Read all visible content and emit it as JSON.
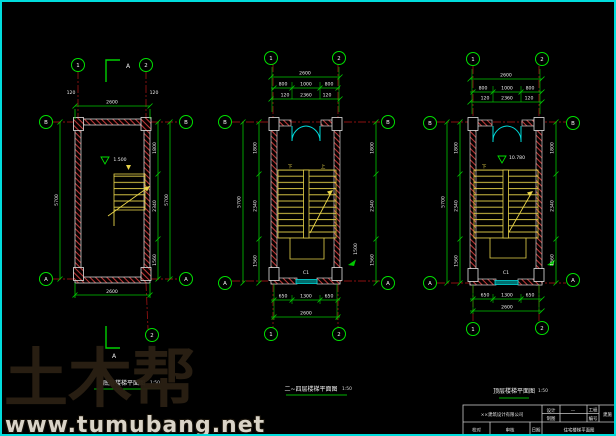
{
  "watermark": {
    "logo": "土木帮",
    "url": "www.tumubang.net"
  },
  "section_marks": {
    "top_label": "A",
    "bottom_label": "A"
  },
  "colors": {
    "dim_green": "#00c800",
    "axis_red": "#8c1111",
    "stair_yellow": "#e8d44a",
    "door_cyan": "#00d9d9"
  },
  "plans": [
    {
      "title": "底层楼梯平面图",
      "scale": "1:50",
      "elevation": "1.500",
      "axes": {
        "v1": "1",
        "v2": "2",
        "v_bottom": "2",
        "h_top": "B",
        "h_bottom": "A"
      },
      "dims": {
        "top_overall": "2600",
        "side_left_small": "120",
        "side_right_small": "120",
        "bottom_overall": "2600",
        "left_overall": "5700",
        "right_chain": [
          "1800",
          "2340",
          "1560"
        ],
        "right_overall": "5700"
      }
    },
    {
      "title": "二~四层楼梯平面图",
      "scale": "1:50",
      "flight_up": "上",
      "flight_down": "下",
      "window_tag": "C1",
      "axes": {
        "v1": "1",
        "v2": "2",
        "h_top": "B",
        "h_bottom": "A"
      },
      "dims": {
        "top_overall": "2600",
        "top_chain": [
          "800",
          "1000",
          "800"
        ],
        "top_chain2": [
          "120",
          "2360",
          "120"
        ],
        "bottom_chain": [
          "650",
          "1300",
          "650"
        ],
        "bottom_overall": "2600",
        "left_overall": "5700",
        "left_chain": [
          "1800",
          "2340",
          "1560"
        ],
        "right_chain": [
          "1800",
          "2340",
          "1560"
        ],
        "window_dim": "1500"
      }
    },
    {
      "title": "顶层楼梯平面图",
      "scale": "1:50",
      "elevation": "10.780",
      "flight_down": "下",
      "window_tag": "C1",
      "axes": {
        "v1": "1",
        "v2": "2",
        "h_top": "B",
        "h_bottom": "A"
      },
      "dims": {
        "top_overall": "2600",
        "top_chain": [
          "800",
          "1000",
          "800"
        ],
        "top_chain2": [
          "120",
          "2360",
          "120"
        ],
        "bottom_chain": [
          "650",
          "1300",
          "650"
        ],
        "bottom_overall": "2600",
        "left_overall": "5700",
        "left_chain": [
          "1800",
          "2340",
          "1560"
        ],
        "right_chain": [
          "1800",
          "2340",
          "1560"
        ]
      }
    }
  ],
  "title_block": {
    "company": "××建筑设计有限公司",
    "design_label": "设计",
    "draft_label": "制图",
    "dash": "—",
    "proj_label": "工程",
    "no_label": "编号",
    "stage": "建施",
    "check_label": "校对",
    "audit_label": "审核",
    "date_label": "日期",
    "drawing_name": "住宅楼梯平面图"
  }
}
